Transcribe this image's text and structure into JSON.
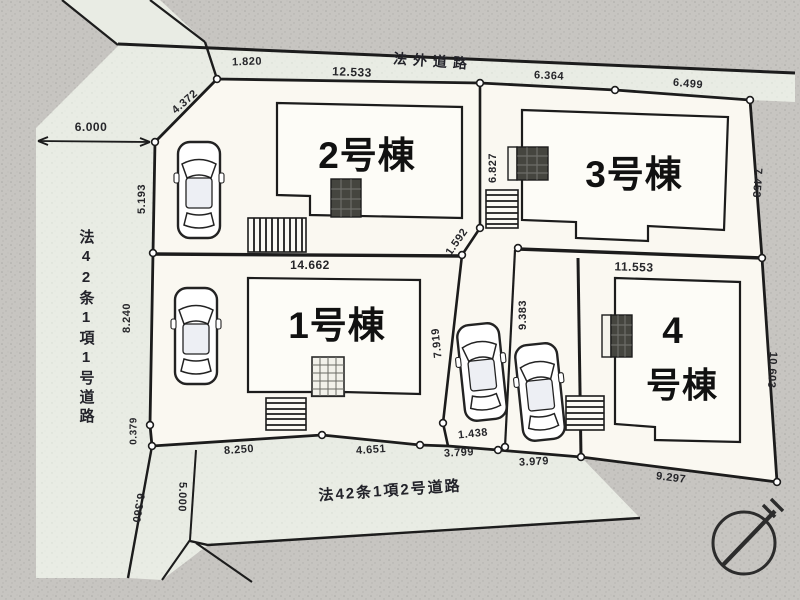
{
  "plan": {
    "title": "区画配置図",
    "roads": {
      "top": "法外道路",
      "left": "法42条1項1号道路",
      "bottom": "法42条1項2号道路"
    },
    "lots": {
      "lot1": "1号棟",
      "lot2": "2号棟",
      "lot3": "3号棟",
      "lot4_line1": "4",
      "lot4_line2": "号棟"
    },
    "dims": {
      "a1820": "1.820",
      "a12533": "12.533",
      "a6364": "6.364",
      "a6499": "6.499",
      "a6000": "6.000",
      "a4372": "4.372",
      "a5193": "5.193",
      "a8240": "8.240",
      "a0379": "0.379",
      "a14662": "14.662",
      "a6827": "6.827",
      "a1592": "1.592",
      "a7919": "7.919",
      "a9383": "9.383",
      "a11553": "11.553",
      "a1438": "1.438",
      "a8250": "8.250",
      "a4651": "4.651",
      "a3799": "3.799",
      "a3979": "3.979",
      "a9297": "9.297",
      "a7453": "7.453",
      "a10603": "10.603",
      "a6360": "6.360",
      "a5000": "5.000"
    },
    "icons": {
      "compass": "north-arrow-compass",
      "car": "car-top-view",
      "stairs": "entrance-steps",
      "porch": "entrance-porch"
    },
    "colors": {
      "outer": "#c7c5c1",
      "road": "#e9ece4",
      "plot": "#faf8f1",
      "building": "#fdfcf7",
      "line": "#1c1c1c",
      "porchdark": "#45453f"
    }
  }
}
